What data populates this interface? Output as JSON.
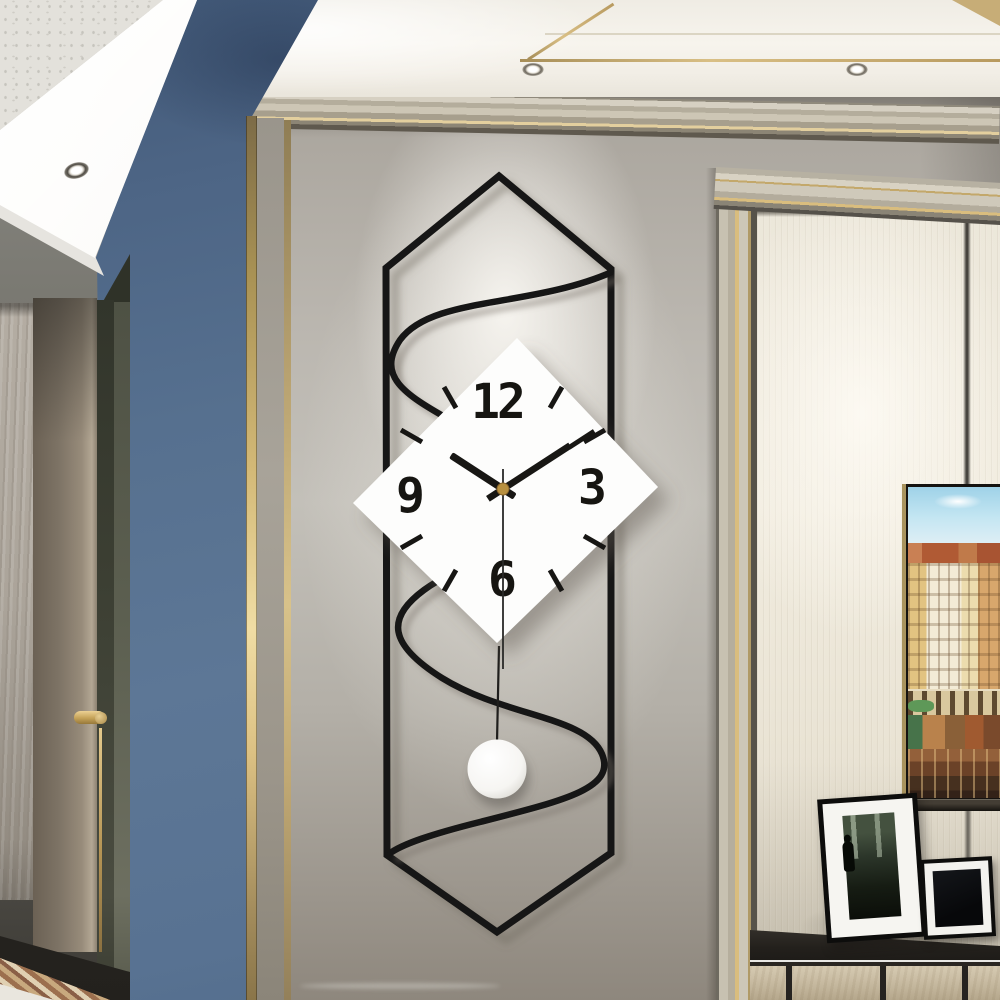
{
  "scene": {
    "type": "interior photograph",
    "subject": "modern geometric pendulum wall clock on a wall between a blue accent wall and a paneled niche"
  },
  "clock": {
    "numerals": {
      "twelve": "12",
      "three": "3",
      "six": "6",
      "nine": "9"
    },
    "time": {
      "approx_time": "10:09",
      "hour_angle_deg": 303,
      "minute_angle_deg": 57,
      "second_angle_deg": 180
    }
  },
  "colors": {
    "blue-wall": "#57708f",
    "gray-wall": "#bab6ae",
    "ceiling": "#f5f2eb",
    "gold": "#c9ae72",
    "gold-bright": "#eedaa2",
    "cream-wall": "#eee9dc",
    "clock-black": "#181714",
    "face-white": "#fdfdfc",
    "pin-gold": "#b8903f",
    "door-frame": "#3c3f33",
    "cabinet-top": "#2b2824",
    "cabinet-wood": "#cdc1a9",
    "frame-black": "#0d0d0c",
    "sky-blue": "#aedcee",
    "roof-red": "#aa5532",
    "building-cream": "#e9d8a6",
    "boat-brown": "#6b4228",
    "mosaic-tan": "#b28a60"
  }
}
